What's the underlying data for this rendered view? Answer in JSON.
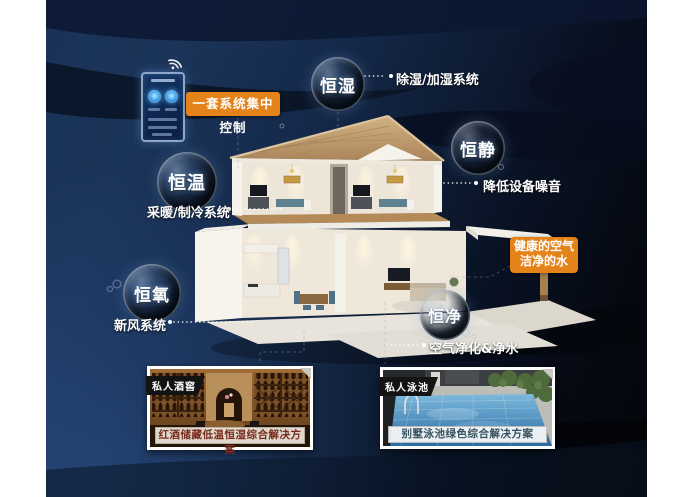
{
  "control": {
    "wifi_icon": "wifi-icon",
    "label": "一套系统集中控制"
  },
  "features": {
    "humidity": {
      "bubble": "恒湿",
      "label": "除湿/加湿系统"
    },
    "quiet": {
      "bubble": "恒静",
      "label": "降低设备噪音"
    },
    "temp": {
      "bubble": "恒温",
      "label": "采暖/制冷系统"
    },
    "oxygen": {
      "bubble": "恒氧",
      "label": "新风系统"
    },
    "purity": {
      "bubble": "恒净",
      "label": "空气净化&净水"
    }
  },
  "highlight": {
    "line1": "健康的空气",
    "line2": "洁净的水"
  },
  "photos": {
    "cellar": {
      "tag": "私人酒窖",
      "caption": "红酒储藏低温恒湿综合解决方案"
    },
    "pool": {
      "tag": "私人泳池",
      "caption": "别墅泳池绿色综合解决方案"
    }
  },
  "colors": {
    "accent_orange": "#e5831b",
    "background_navy": "#16294a",
    "bubble_text": "#ffffff",
    "wine_caption_text": "#7a2a1c",
    "pool_caption_text": "#35505e"
  }
}
